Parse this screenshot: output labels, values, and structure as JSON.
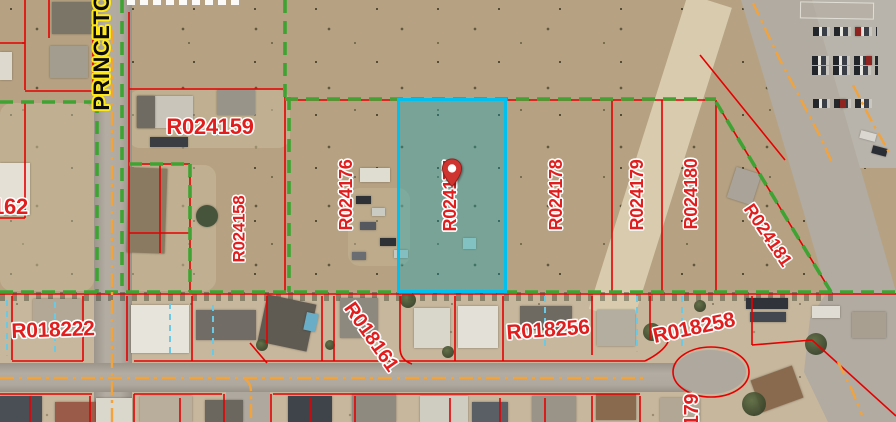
{
  "map_labels": {
    "street": "PRINCETO",
    "parcels_upper": [
      "R024159",
      "R024158",
      "R024176",
      "R024177",
      "R024178",
      "R024179",
      "R024180",
      "R024181"
    ],
    "parcel_left_cutoff": "162",
    "parcels_lower": [
      "R018222",
      "R018161",
      "R018256",
      "R018258"
    ],
    "parcel_bottom_cutoff": "179"
  },
  "selected_parcel": {
    "id": "R024177",
    "marker": "location-pin"
  },
  "colors": {
    "parcel_line_red": "#e60000",
    "boundary_green_dashed": "#3ea332",
    "highlight_border_cyan": "#00c0f0",
    "highlight_fill": "rgba(0,168,190,0.33)",
    "lot_split_cyan_dashed": "#6cc9e4",
    "road_centerline_orange": "#f2a33c",
    "label_text_red": "#e11d1d",
    "street_label_text": "#0a0a0a",
    "street_label_halo": "#ffe81a",
    "pin_red": "#cf3430"
  }
}
